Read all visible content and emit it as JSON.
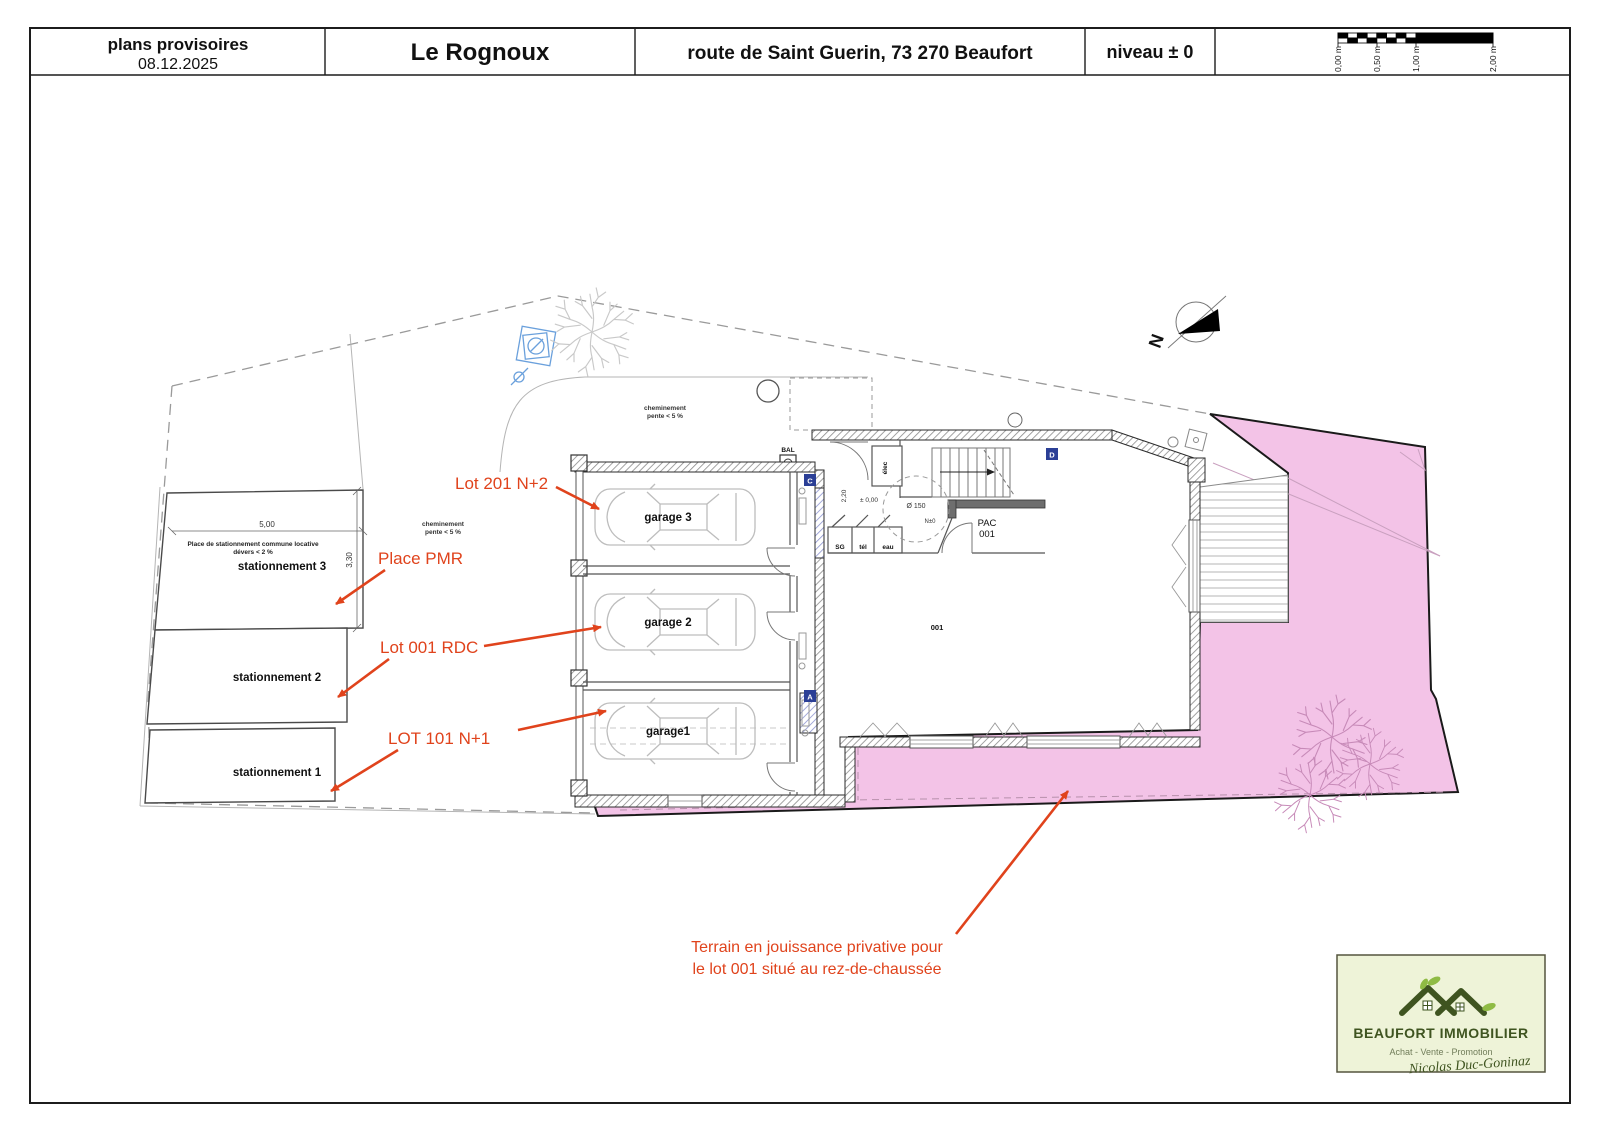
{
  "header": {
    "doc_type": "plans provisoires",
    "date": "08.12.2025",
    "project": "Le Rognoux",
    "address": "route de Saint Guerin,  73 270 Beaufort",
    "level": "niveau ± 0",
    "scale_ticks": [
      "0,00 m",
      "0,50 m",
      "1,00 m",
      "2,00 m"
    ]
  },
  "site": {
    "north_label": "N",
    "parking": {
      "note1": "Place de stationnement commune locative",
      "note2": "dévers < 2 %",
      "dim_width": "5,00",
      "dim_depth": "3,30",
      "space3": "stationnement 3",
      "space2": "stationnement 2",
      "space1": "stationnement 1"
    },
    "path_note_line1": "cheminement",
    "path_note_line2": "pente < 5 %",
    "mailbox": "BAL"
  },
  "building": {
    "garage3": "garage 3",
    "garage2": "garage 2",
    "garage1": "garage1",
    "elec": "élec",
    "sg": "SG",
    "tel": "tél",
    "eau": "eau",
    "level_zero": "± 0,00",
    "door_height": "2,20",
    "turn_circle": "Ø 150",
    "n_zero": "N±0",
    "pac_line1": "PAC",
    "pac_line2": "001",
    "room_001": "001",
    "section_c": "C",
    "section_a": "A",
    "section_d": "D"
  },
  "annotations": {
    "lot201": "Lot  201 N+2",
    "place_pmr": "Place PMR",
    "lot001": "Lot 001 RDC",
    "lot101": "LOT 101 N+1",
    "terrain_line1": "Terrain en jouissance privative pour",
    "terrain_line2": "le lot 001 situé au rez-de-chaussée"
  },
  "logo": {
    "company": "BEAUFORT  IMMOBILIER",
    "tagline": "Achat - Vente - Promotion",
    "signature": "Nicolas Duc-Goninaz"
  },
  "colors": {
    "terrain_pink": "#f3c3e7",
    "annotation_red": "#e0431c",
    "section_blue": "#2b3f96",
    "drain_blue": "#6aa0dc",
    "logo_bg": "#eef3d8",
    "logo_green": "#3f5420",
    "leaf_green": "#8fbb44"
  }
}
